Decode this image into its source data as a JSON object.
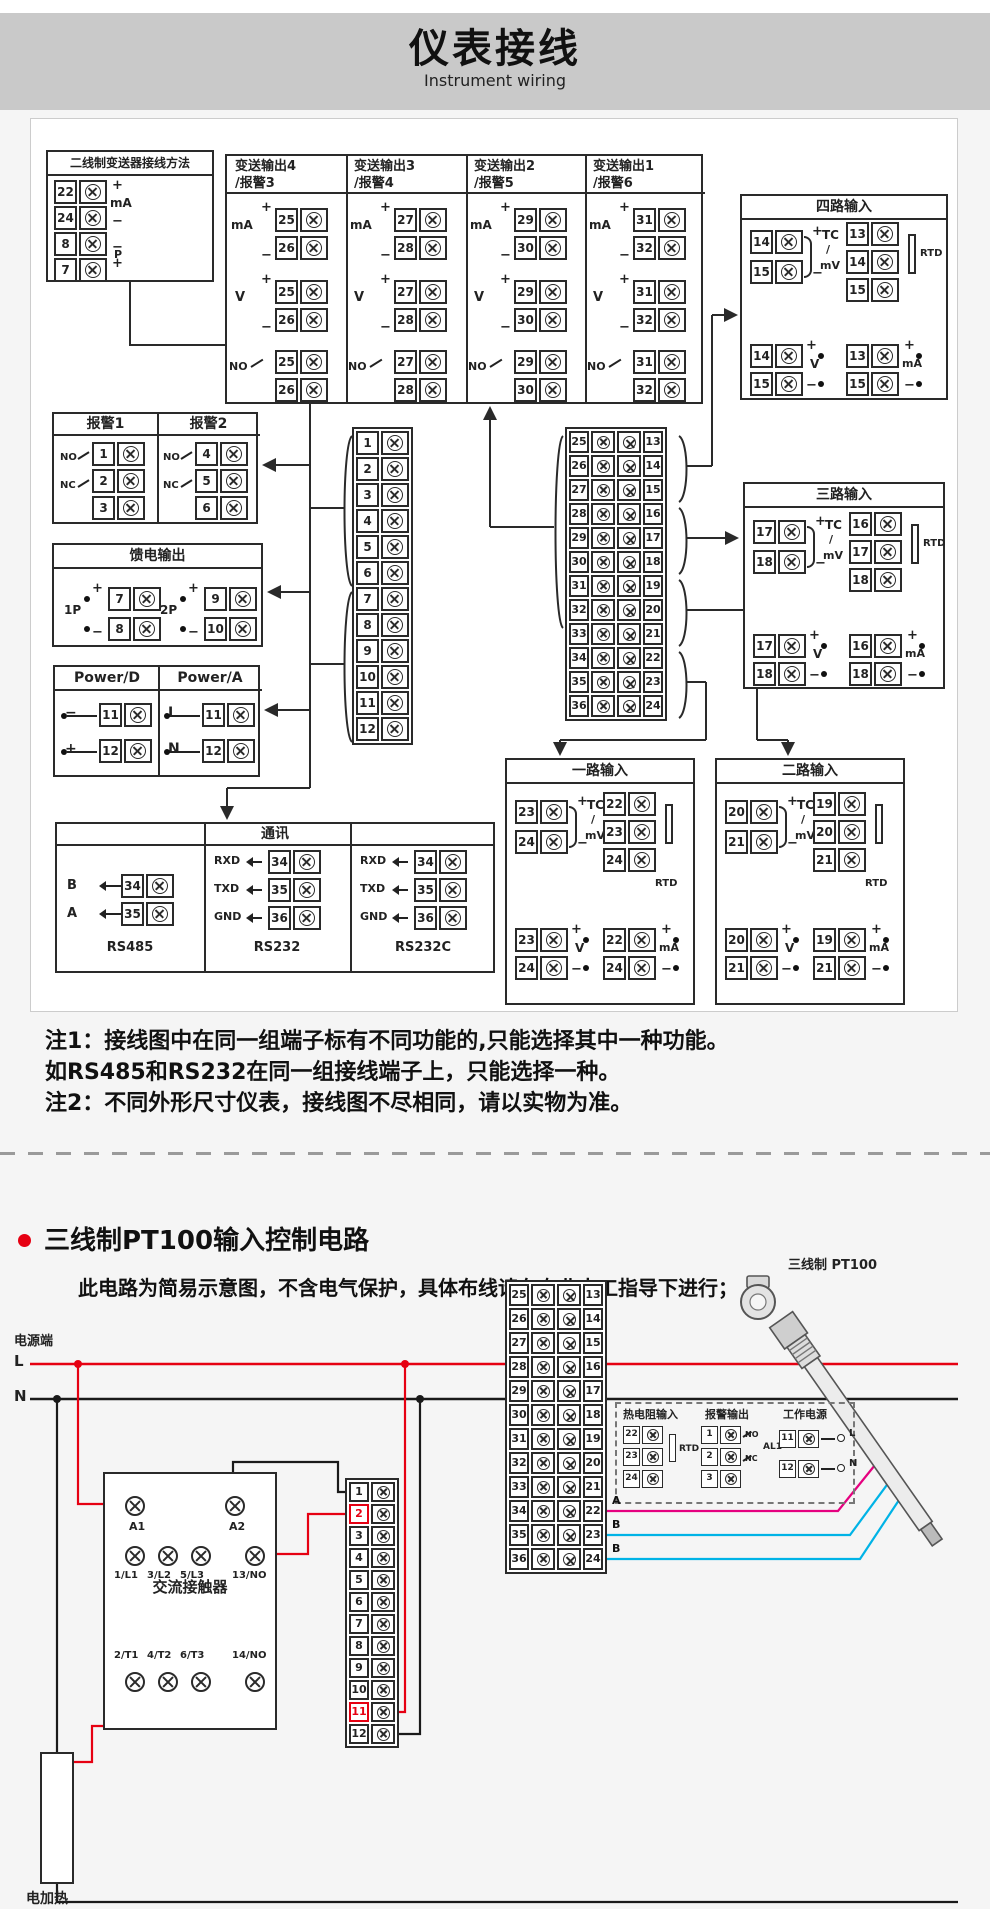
{
  "header": {
    "title": "仪表接线",
    "subtitle": "Instrument wiring"
  },
  "wiring": {
    "two_wire": {
      "title": "二线制变送器接线方法",
      "terminals": [
        {
          "n": "22",
          "sign": "+"
        },
        {
          "n": "24",
          "sign": "−"
        },
        {
          "n": "8",
          "sign": "−"
        },
        {
          "n": "7",
          "sign": "+"
        }
      ],
      "ma_label": "mA",
      "p_label": "P"
    },
    "signs": {
      "plus": "+",
      "minus": "−"
    },
    "transmit": {
      "row_labels": {
        "ma": "mA",
        "v": "V",
        "no": "NO"
      },
      "columns": [
        {
          "title": "变送输出4",
          "subtitle": "/报警3",
          "t_top": "25",
          "t_bot": "26"
        },
        {
          "title": "变送输出3",
          "subtitle": "/报警4",
          "t_top": "27",
          "t_bot": "28"
        },
        {
          "title": "变送输出2",
          "subtitle": "/报警5",
          "t_top": "29",
          "t_bot": "30"
        },
        {
          "title": "变送输出1",
          "subtitle": "/报警6",
          "t_top": "31",
          "t_bot": "32"
        }
      ]
    },
    "input_labels": {
      "tc": "TC",
      "slash": "/",
      "mv": "mV",
      "rtd": "RTD",
      "v": "V",
      "ma": "mA"
    },
    "input_boxes": [
      {
        "title": "四路输入",
        "tc_plus": "14",
        "tc_minus": "15",
        "rtd": [
          "13",
          "14",
          "15"
        ],
        "v_plus": "14",
        "v_minus": "15",
        "ma_plus": "13",
        "ma_minus": "15"
      },
      {
        "title": "三路输入",
        "tc_plus": "17",
        "tc_minus": "18",
        "rtd": [
          "16",
          "17",
          "18"
        ],
        "v_plus": "17",
        "v_minus": "18",
        "ma_plus": "16",
        "ma_minus": "18"
      },
      {
        "title": "一路输入",
        "tc_plus": "23",
        "tc_minus": "24",
        "rtd": [
          "22",
          "23",
          "24"
        ],
        "v_plus": "23",
        "v_minus": "24",
        "ma_plus": "22",
        "ma_minus": "24"
      },
      {
        "title": "二路输入",
        "tc_plus": "20",
        "tc_minus": "21",
        "rtd": [
          "19",
          "20",
          "21"
        ],
        "v_plus": "20",
        "v_minus": "21",
        "ma_plus": "19",
        "ma_minus": "21"
      }
    ],
    "alarm": {
      "cols": [
        {
          "title": "报警1",
          "terminals": [
            "1",
            "2",
            "3"
          ]
        },
        {
          "title": "报警2",
          "terminals": [
            "4",
            "5",
            "6"
          ]
        }
      ],
      "no": "NO",
      "nc": "NC"
    },
    "feed": {
      "title": "馈电输出",
      "groups": [
        {
          "label": "1P",
          "t_plus": "7",
          "t_minus": "8"
        },
        {
          "label": "2P",
          "t_plus": "9",
          "t_minus": "10"
        }
      ]
    },
    "power": {
      "cols": [
        {
          "title": "Power/D",
          "rows": [
            {
              "sign": "−",
              "n": "11"
            },
            {
              "sign": "+",
              "n": "12"
            }
          ]
        },
        {
          "title": "Power/A",
          "rows": [
            {
              "sign": "L",
              "n": "11"
            },
            {
              "sign": "N",
              "n": "12"
            }
          ]
        }
      ]
    },
    "comm": {
      "title": "通讯",
      "cols": [
        {
          "name": "RS485",
          "rows": [
            {
              "label": "B",
              "n": "34"
            },
            {
              "label": "A",
              "n": "35"
            }
          ]
        },
        {
          "name": "RS232",
          "rows": [
            {
              "label": "RXD",
              "n": "34"
            },
            {
              "label": "TXD",
              "n": "35"
            },
            {
              "label": "GND",
              "n": "36"
            }
          ]
        },
        {
          "name": "RS232C",
          "rows": [
            {
              "label": "RXD",
              "n": "34"
            },
            {
              "label": "TXD",
              "n": "35"
            },
            {
              "label": "GND",
              "n": "36"
            }
          ]
        }
      ]
    },
    "strip_single": [
      "1",
      "2",
      "3",
      "4",
      "5",
      "6",
      "7",
      "8",
      "9",
      "10",
      "11",
      "12"
    ],
    "strip_double_left": [
      "25",
      "26",
      "27",
      "28",
      "29",
      "30",
      "31",
      "32",
      "33",
      "34",
      "35",
      "36"
    ],
    "strip_double_right": [
      "13",
      "14",
      "15",
      "16",
      "17",
      "18",
      "19",
      "20",
      "21",
      "22",
      "23",
      "24"
    ]
  },
  "notes": {
    "line1": "注1：接线图中在同一组端子标有不同功能的,只能选择其中一种功能。",
    "line2": "如RS485和RS232在同一组接线端子上，只能选择一种。",
    "line3": "注2：不同外形尺寸仪表，接线图不尽相同，请以实物为准。"
  },
  "pt100": {
    "title": "三线制PT100输入控制电路",
    "subtitle": "此电路为简易示意图，不含电气保护，具体布线请在专业电工指导下进行；",
    "power_terminal": "电源端",
    "l": "L",
    "n": "N",
    "dashed_box": {
      "cols": [
        {
          "title": "热电阻输入",
          "terminals": [
            "22",
            "23",
            "24"
          ],
          "tag": "RTD"
        },
        {
          "title": "报警输出",
          "terminals": [
            "1",
            "2",
            "3"
          ],
          "no": "NO",
          "nc": "NC",
          "tag": "AL1"
        },
        {
          "title": "工作电源",
          "terminals": [
            "11",
            "12"
          ],
          "l": "L",
          "n": "N"
        }
      ]
    },
    "contactor": {
      "label": "交流接触器",
      "coil_left": "A1",
      "coil_right": "A2",
      "top_contacts": [
        "1/L1",
        "3/L2",
        "5/L3",
        "13/NO"
      ],
      "bottom_contacts": [
        "2/T1",
        "4/T2",
        "6/T3",
        "14/NO"
      ]
    },
    "sensor_label": "三线制 PT100",
    "wire_labels": [
      "A",
      "B",
      "B"
    ],
    "heater_label": "电加热",
    "highlight_rows": [
      "2",
      "11"
    ]
  },
  "colors": {
    "red": "#e60012",
    "magenta": "#e5007f",
    "cyan": "#00b3e6",
    "line": "#2a2a2a",
    "banner_bg": "#c9c9c9"
  }
}
